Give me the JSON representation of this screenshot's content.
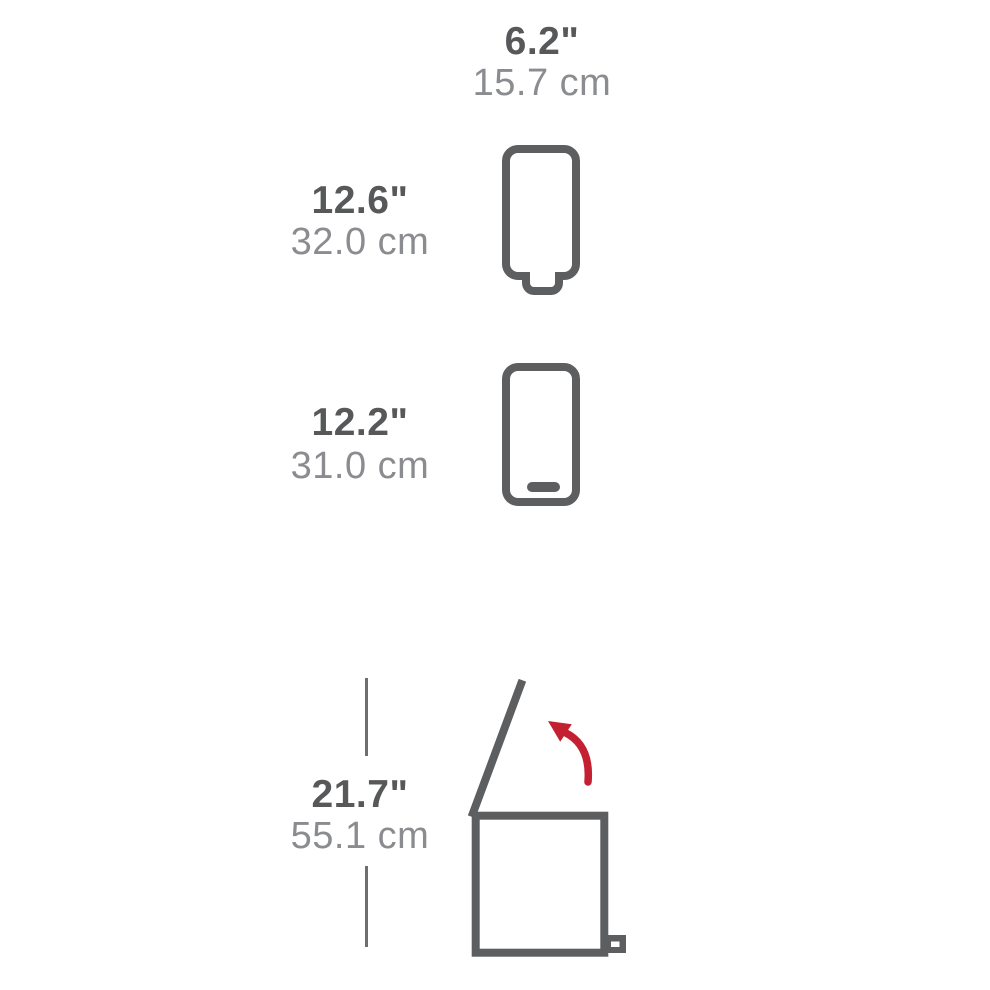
{
  "diagram": {
    "kind": "product-dimensions-diagram",
    "background": "#ffffff"
  },
  "colors": {
    "outline_gray": "#5c5e60",
    "label_bold_gray": "#57585a",
    "label_light_gray": "#8a8c8f",
    "dimension_line_gray": "#6c6e70",
    "arrow_red": "#c32032"
  },
  "measurements": {
    "width": {
      "inches": "6.2\"",
      "cm": "15.7 cm"
    },
    "height_closed": {
      "inches": "12.6\"",
      "cm": "32.0 cm"
    },
    "depth": {
      "inches": "12.2\"",
      "cm": "31.0 cm"
    },
    "height_lid_open": {
      "inches": "21.7\"",
      "cm": "55.1 cm"
    }
  },
  "icons": {
    "front_view": "trash-can-front-outline",
    "side_view": "trash-can-side-outline",
    "open_view": "trash-can-lid-open-outline",
    "arrow": "lid-opening-arc-arrow"
  }
}
